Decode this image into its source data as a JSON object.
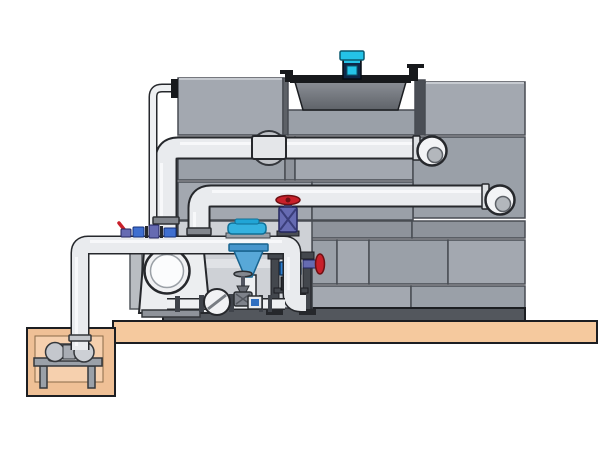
{
  "meta": {
    "description": "Technical side-view illustration of a closed-circuit cooling tower installation with panel casing, fan cowl and motor, riser piping, pump skid with valves, separator filter, support frame, concrete slab and sump pit with sump pump",
    "canvas": {
      "width": 600,
      "height": 450
    }
  },
  "colors": {
    "background": "#ffffff",
    "slab": "#f5c99e",
    "pit": "#efc096",
    "pit_inner": "#f6d0ae",
    "panel": "#9aa0a8",
    "panel_light": "#a3a8b0",
    "panel_dark": "#8e939b",
    "panel_edge": "#5d6167",
    "seam": "#484c53",
    "rail": "#53575d",
    "bay": "#ced1d6",
    "bay_strip": "#e0e2e6",
    "cowl_top": "#8a8e95",
    "cowl_bottom": "#5f6369",
    "black": "#17191c",
    "motor_cyan": "#24c3e8",
    "motor_navy": "#0e2748",
    "pipe": "#e9ebee",
    "pipe_outline": "#26282c",
    "pipe_highlight": "#f7f8fa",
    "pump_body": "#eceef0",
    "red": "#c9202a",
    "valve_purple": "#666bb2",
    "fitting_blue": "#3f6fd0",
    "filter_blue": "#58a8d8",
    "filter_cap": "#35b2e0",
    "frame": "#43474d",
    "steel": "#82868d"
  },
  "components": {
    "tower": "cooling tower panel casing",
    "fan_cowl": "fan cowl",
    "fan_motor": "fan motor",
    "upper_pipe": "upper riser and inlet pipe",
    "lower_pipe": "lower riser and inlet pipe",
    "header": "pump discharge header",
    "sump_pipe": "sump suction pipe",
    "sump_pump": "sump pump on stand",
    "pit": "sump pit",
    "slab": "concrete slab",
    "pump": "circulation pump",
    "check_valve": "check valve",
    "gate_valve": "gate valve",
    "handwheel_valve_top": "handwheel gate valve on elbow",
    "handwheel_valve_side": "handwheel gate valve side",
    "separator": "separator filter with cone",
    "support_frame": "steel support frame",
    "dosing": "dosing fittings on header"
  }
}
